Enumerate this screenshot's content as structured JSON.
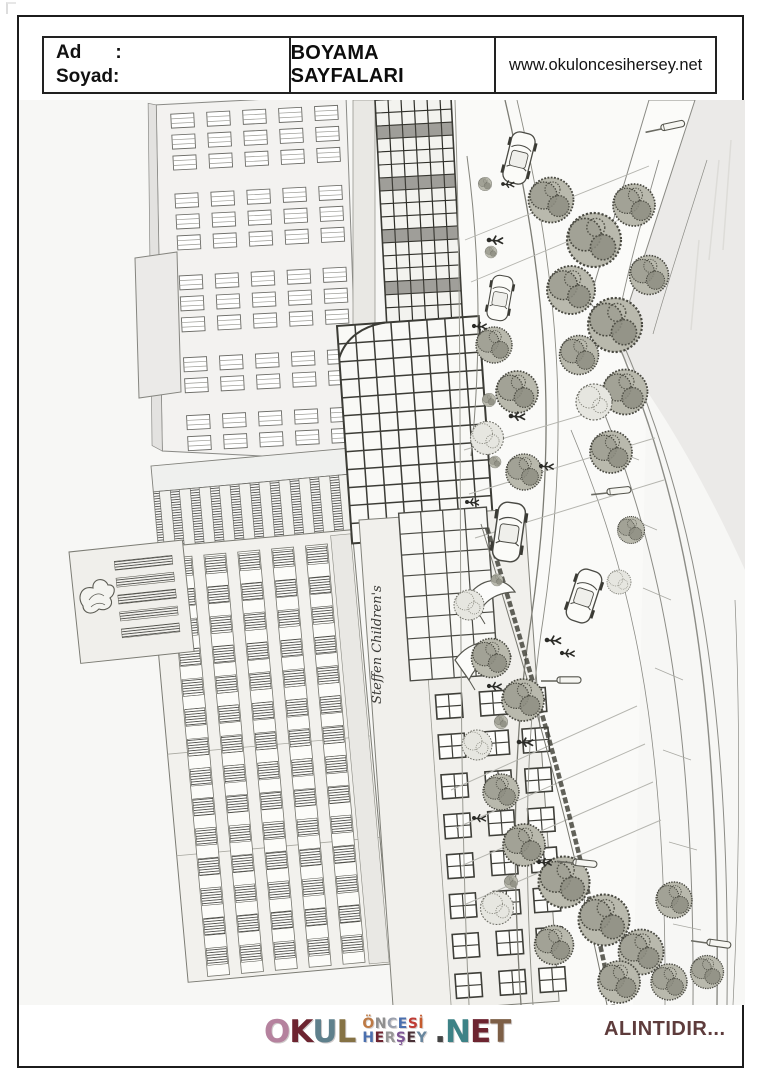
{
  "header": {
    "name_label": "Ad",
    "name_colon": ":",
    "surname_label": "Soyad:",
    "title": "BOYAMA SAYFALARI",
    "website": "www.okuloncesihersey.net"
  },
  "illustration": {
    "description": "Black-and-white architectural line drawing (rotated 90 degrees) of a children's hospital street scene with tall window-grid buildings, glass canopies, trees, cars, pedestrians and a curved plaza, meant to be colored in.",
    "building_sign": "Steffen Children's"
  },
  "footer": {
    "attribution": "ALINTIDIR...",
    "logo": {
      "okul": [
        {
          "ch": "O",
          "color": "#b5829e"
        },
        {
          "ch": "K",
          "color": "#6d2430"
        },
        {
          "ch": "U",
          "color": "#5f808c"
        },
        {
          "ch": "L",
          "color": "#857244"
        }
      ],
      "oncesi": [
        {
          "ch": "Ö",
          "color": "#bd7a45"
        },
        {
          "ch": "N",
          "color": "#8e8e8e"
        },
        {
          "ch": "C",
          "color": "#9aa0ad"
        },
        {
          "ch": "E",
          "color": "#4a6fae"
        },
        {
          "ch": "S",
          "color": "#bf3b34"
        },
        {
          "ch": "İ",
          "color": "#c65b2e"
        }
      ],
      "hersey": [
        {
          "ch": "H",
          "color": "#4a6fae"
        },
        {
          "ch": "E",
          "color": "#6d2430"
        },
        {
          "ch": "R",
          "color": "#969696"
        },
        {
          "ch": "Ş",
          "color": "#7e5696"
        },
        {
          "ch": "E",
          "color": "#4a3037"
        },
        {
          "ch": "Y",
          "color": "#68869e"
        }
      ],
      "net": [
        {
          "ch": ".",
          "color": "#444444"
        },
        {
          "ch": "N",
          "color": "#3d8286"
        },
        {
          "ch": "E",
          "color": "#6d2430"
        },
        {
          "ch": "T",
          "color": "#7d5f46"
        }
      ]
    }
  },
  "colors": {
    "attribution_text": "#5e3c3c",
    "page_border": "#1c1c1c",
    "sketch_line": "#55554d",
    "paper": "#f7f7f5"
  }
}
